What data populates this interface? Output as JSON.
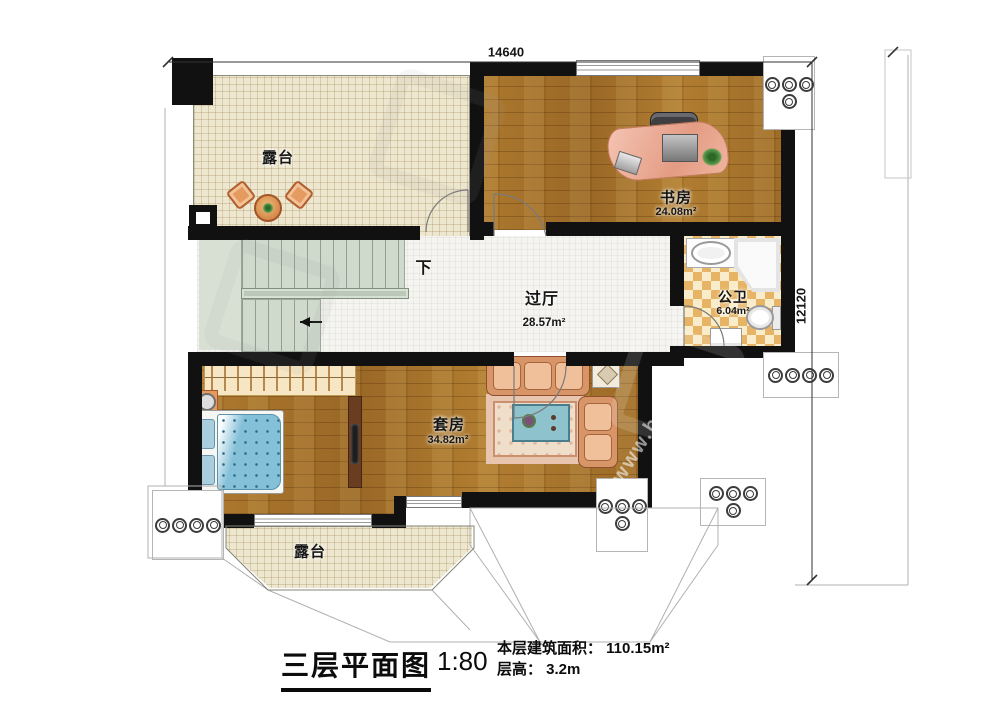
{
  "footer": {
    "title": "三层平面图",
    "scale": "1:80",
    "area_line": "本层建筑面积： 110.15m²",
    "height_line": "层高： 3.2m"
  },
  "dimensions": {
    "top": "14640",
    "right": "12120"
  },
  "rooms": {
    "terrace_top": {
      "name": "露台"
    },
    "study": {
      "name": "书房",
      "area": "24.08m²"
    },
    "hall": {
      "name": "过厅",
      "area": "28.57m²"
    },
    "bath": {
      "name": "公卫",
      "area": "6.04m²"
    },
    "suite": {
      "name": "套房",
      "area": "34.82m²"
    },
    "terrace_bottom": {
      "name": "露台"
    }
  },
  "annotations": {
    "stairs_down": "下"
  },
  "watermark": {
    "url_fragment": "www.bai"
  },
  "colors": {
    "wall": "#111111",
    "wood_floor": "#a5701f",
    "terrace_floor": "#eee7d0",
    "tile_floor": "#f5f4f0",
    "stair_floor": "#ccd7cb",
    "bath_checker": "#e7b465",
    "bed_blue": "#84c0d8",
    "sofa_salmon": "#e2a078",
    "desk_salmon": "#e9a78f"
  }
}
